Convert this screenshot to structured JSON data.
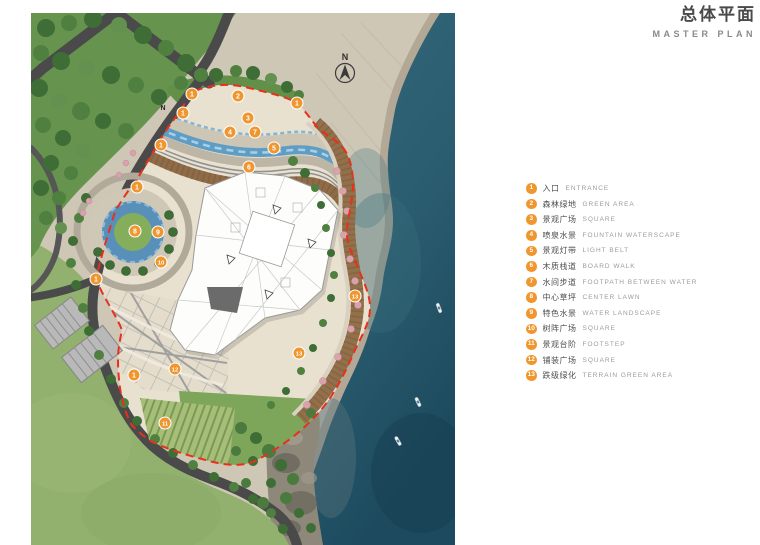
{
  "header": {
    "title_cn": "总体平面",
    "title_en": "MASTER PLAN"
  },
  "map": {
    "north_label": "N",
    "inner_north_label": "N",
    "markers": [
      {
        "num": "1",
        "x": 161,
        "y": 81
      },
      {
        "num": "1",
        "x": 152,
        "y": 100
      },
      {
        "num": "1",
        "x": 130,
        "y": 132
      },
      {
        "num": "1",
        "x": 106,
        "y": 174
      },
      {
        "num": "1",
        "x": 65,
        "y": 266
      },
      {
        "num": "1",
        "x": 103,
        "y": 362
      },
      {
        "num": "1",
        "x": 266,
        "y": 90
      },
      {
        "num": "2",
        "x": 207,
        "y": 83
      },
      {
        "num": "3",
        "x": 217,
        "y": 105
      },
      {
        "num": "4",
        "x": 199,
        "y": 119
      },
      {
        "num": "7",
        "x": 224,
        "y": 119
      },
      {
        "num": "5",
        "x": 243,
        "y": 135
      },
      {
        "num": "6",
        "x": 218,
        "y": 154
      },
      {
        "num": "8",
        "x": 104,
        "y": 218
      },
      {
        "num": "9",
        "x": 127,
        "y": 219
      },
      {
        "num": "10",
        "x": 130,
        "y": 249
      },
      {
        "num": "12",
        "x": 144,
        "y": 356
      },
      {
        "num": "11",
        "x": 134,
        "y": 410
      },
      {
        "num": "13",
        "x": 324,
        "y": 283
      },
      {
        "num": "13",
        "x": 268,
        "y": 340
      }
    ],
    "boats": [
      {
        "x": 408,
        "y": 295,
        "angle": 70
      },
      {
        "x": 387,
        "y": 389,
        "angle": 65
      },
      {
        "x": 367,
        "y": 428,
        "angle": 60
      }
    ]
  },
  "legend": {
    "items": [
      {
        "num": "1",
        "cn": "入口",
        "en": "ENTRANCE"
      },
      {
        "num": "2",
        "cn": "森林绿地",
        "en": "GREEN AREA"
      },
      {
        "num": "3",
        "cn": "景观广场",
        "en": "SQUARE"
      },
      {
        "num": "4",
        "cn": "喷泉水景",
        "en": "FOUNTAIN WATERSCAPE"
      },
      {
        "num": "5",
        "cn": "景观灯带",
        "en": "LIGHT BELT"
      },
      {
        "num": "6",
        "cn": "木质栈道",
        "en": "BOARD WALK"
      },
      {
        "num": "7",
        "cn": "水间步道",
        "en": "FOOTPATH BETWEEN WATER"
      },
      {
        "num": "8",
        "cn": "中心草坪",
        "en": "CENTER LAWN"
      },
      {
        "num": "9",
        "cn": "特色水景",
        "en": "WATER LANDSCAPE"
      },
      {
        "num": "10",
        "cn": "树阵广场",
        "en": "SQUARE"
      },
      {
        "num": "11",
        "cn": "景观台阶",
        "en": "FOOTSTEP"
      },
      {
        "num": "12",
        "cn": "铺装广场",
        "en": "SQUARE"
      },
      {
        "num": "13",
        "cn": "跌级绿化",
        "en": "TERRAIN GREEN AREA"
      }
    ]
  },
  "colors": {
    "accent_orange": "#F0962E",
    "boundary_red": "#E8301A",
    "sea": "#2B5B6C",
    "sand": "#CFC7B6",
    "forest": "#66934E",
    "lawn": "#92B06E"
  }
}
